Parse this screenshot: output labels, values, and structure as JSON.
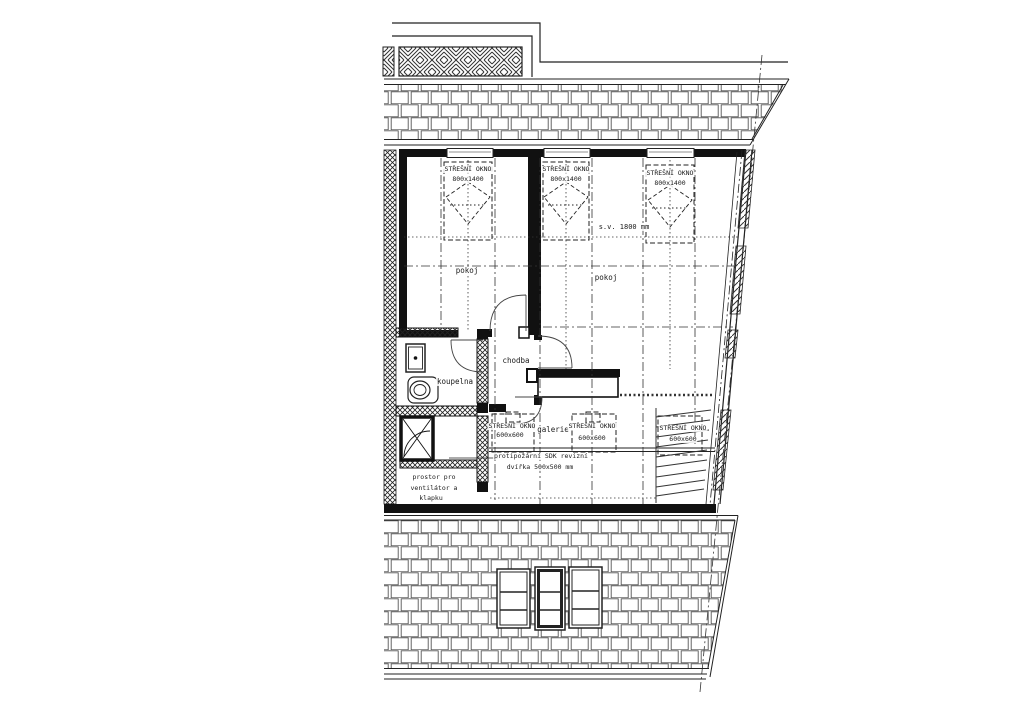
{
  "labels": {
    "room_left": "pokoj",
    "room_right": "pokoj",
    "hallway": "chodba",
    "bathroom": "koupelna",
    "gallery": "galerie",
    "ceiling_height": "s.v. 1800 mm",
    "fire_note_1": "protipožární SDK revizní",
    "fire_note_2": "dvířka 500x500 mm",
    "vent_1": "prostor pro",
    "vent_2": "ventilátor a",
    "vent_3": "klapku"
  },
  "roof_windows_large": [
    {
      "label": "STŘEŠNÍ OKNO",
      "size": "800x1400"
    },
    {
      "label": "STŘEŠNÍ OKNO",
      "size": "800x1400"
    },
    {
      "label": "STŘEŠNÍ OKNO",
      "size": "800x1400"
    }
  ],
  "roof_windows_small": [
    {
      "label": "STŘEŠNÍ OKNO",
      "size": "600x600"
    },
    {
      "label": "STŘEŠNÍ OKNO",
      "size": "600x600"
    },
    {
      "label": "STŘEŠNÍ OKNO",
      "size": "600x600"
    }
  ]
}
